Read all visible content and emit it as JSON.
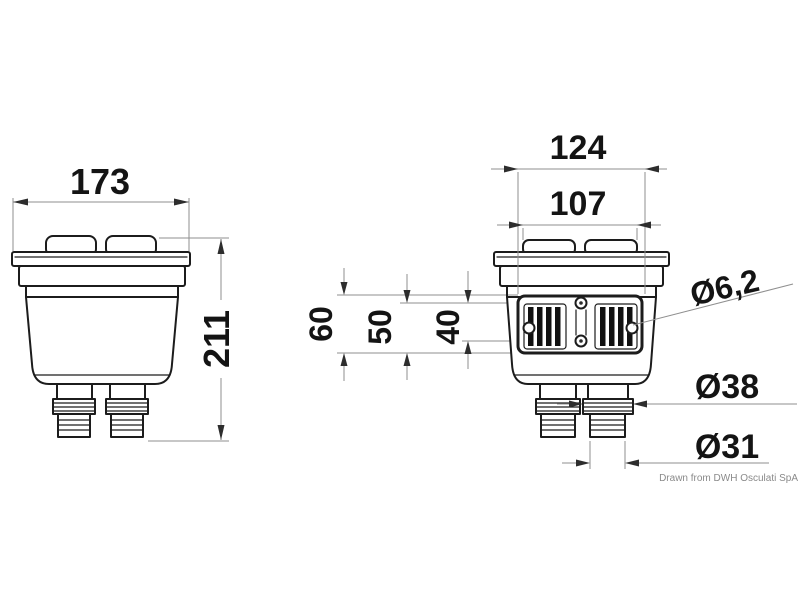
{
  "drawing": {
    "credit": "Drawn from DWH Osculati SpA",
    "colors": {
      "line": "#1c1c1c",
      "dimension_line": "#8f8f8f",
      "arrow": "#2d2d2d",
      "text": "#141414",
      "credit_text": "#8a8a8a",
      "background": "#ffffff"
    },
    "dimensions": {
      "front_width": "173",
      "overall_height": "211",
      "bracket_width": "124",
      "cap_span": "107",
      "spacing_60": "60",
      "spacing_50": "50",
      "spacing_40": "40",
      "mount_hole_diameter": "Ø6,2",
      "hose_barb_diameter": "Ø38",
      "hose_tail_diameter": "Ø31"
    }
  }
}
